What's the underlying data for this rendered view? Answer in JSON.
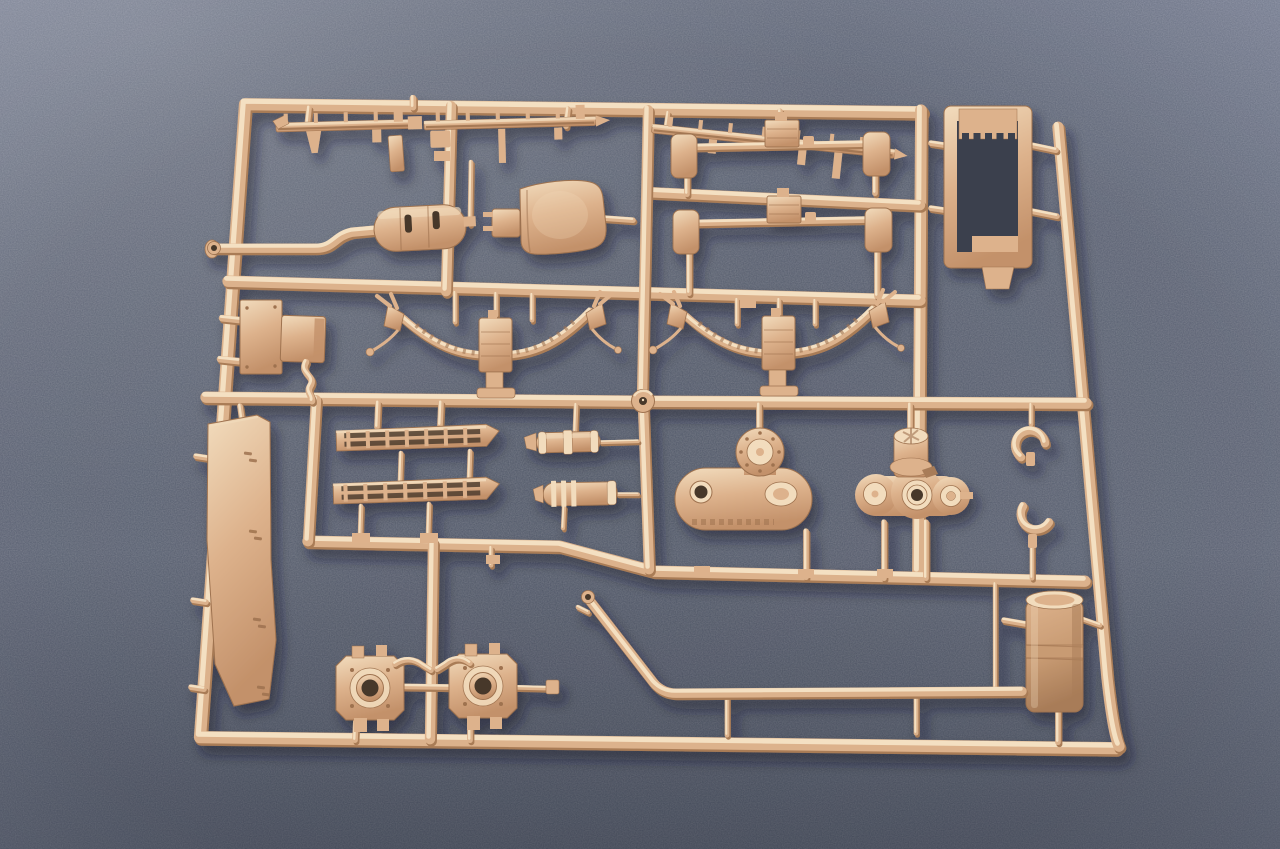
{
  "scene": {
    "subject": "plastic-model-kit-sprue-photo",
    "background_material": "fabric"
  },
  "colors": {
    "bg_center": "#4c5363",
    "bg_mid": "#5b6273",
    "bg_edge": "#7e8599",
    "pl_l": "#f2dcbd",
    "pl_m": "#ddb28c",
    "pl_d": "#c3916a",
    "pl_sh": "#9e724f",
    "cyl_m": "#c89b73",
    "cyl_d": "#a87c58",
    "hole": "#463729",
    "interior": "#3a404d",
    "tube_hi": "#f4e0c2",
    "tube_mid": "#dcb28c",
    "tube_dark": "#a97c57",
    "shadow": "#141925"
  },
  "parts": [
    {
      "name": "sprue-frame",
      "label": "runner frame"
    },
    {
      "name": "narrow-rail-strip-1",
      "label": "stake rail strip"
    },
    {
      "name": "narrow-rail-strip-2",
      "label": "stake rail strip"
    },
    {
      "name": "narrow-rail-strip-3",
      "label": "stake rail strip"
    },
    {
      "name": "muffler-part",
      "label": "muffler with exhaust pipe"
    },
    {
      "name": "seat-part",
      "label": "seat back"
    },
    {
      "name": "stabilizer-bar-upper",
      "label": "axle stabilizer bar"
    },
    {
      "name": "stabilizer-bar-lower",
      "label": "axle stabilizer bar"
    },
    {
      "name": "leaf-spring-left",
      "label": "leaf spring assembly"
    },
    {
      "name": "leaf-spring-right",
      "label": "leaf spring assembly"
    },
    {
      "name": "equipment-box-part",
      "label": "stowage box"
    },
    {
      "name": "side-panel-part",
      "label": "long fender panel"
    },
    {
      "name": "ladder-grille-upper",
      "label": "railed step grille"
    },
    {
      "name": "ladder-grille-lower",
      "label": "railed step grille"
    },
    {
      "name": "small-cylinder-upper",
      "label": "small tank cylinder"
    },
    {
      "name": "small-cylinder-lower",
      "label": "small ribbed cylinder"
    },
    {
      "name": "gearbox-housing",
      "label": "final drive housing"
    },
    {
      "name": "transfer-case",
      "label": "transfer case"
    },
    {
      "name": "tow-hook-upper",
      "label": "tow hook"
    },
    {
      "name": "tow-hook-lower",
      "label": "tow hook"
    },
    {
      "name": "bracket-frame-part",
      "label": "rectangular bracket frame"
    },
    {
      "name": "wheel-hub-left",
      "label": "wheel hub"
    },
    {
      "name": "wheel-hub-right",
      "label": "wheel hub"
    },
    {
      "name": "fuel-drum-part",
      "label": "cylindrical drum"
    },
    {
      "name": "long-pipe-part",
      "label": "long exhaust pipe"
    },
    {
      "name": "center-gate-ring",
      "label": "sprue gate ring"
    }
  ]
}
